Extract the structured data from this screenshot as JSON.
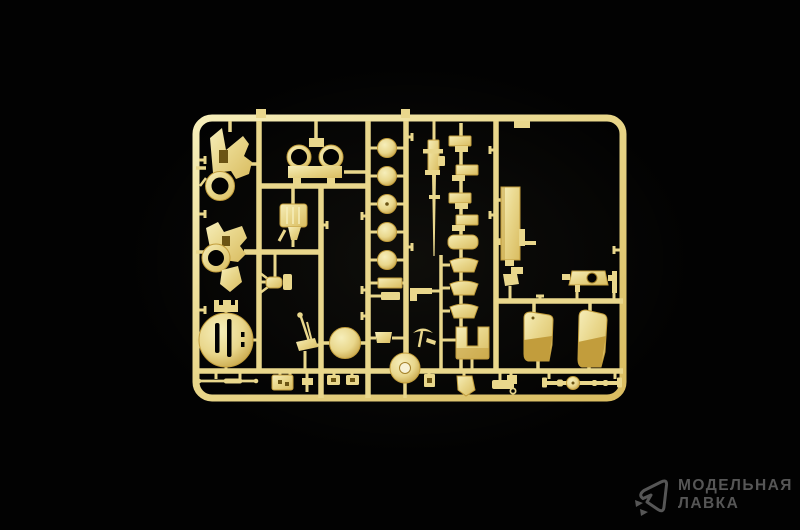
{
  "photo": {
    "type": "product-photo",
    "subject": "model-kit-sprue",
    "background_color": "#020202"
  },
  "sprue": {
    "plastic_color": "#e9d78c",
    "plastic_light": "#f6eeba",
    "plastic_dark": "#c29d3c",
    "plastic_deep": "#6b5414",
    "parts": [
      "sprue-frame",
      "runners",
      "gate-clips",
      "transfer-case-a",
      "transfer-case-b",
      "slotted-disc",
      "front-axle",
      "tool-box",
      "twin-ring-mount",
      "jerry-can",
      "tow-hitch",
      "gear-lever",
      "road-wheel",
      "hub-discs",
      "spare-hub-disc",
      "small-trapezoid-bracket",
      "machine-gun",
      "pickaxe",
      "l-bracket",
      "leaf-spring-brackets",
      "mudguard-panels",
      "u-shaped-panel",
      "chassis-rail",
      "rail-feet",
      "gun-mount-plate",
      "seat-left",
      "seat-right",
      "rear-axle",
      "plate-pair",
      "small-brackets",
      "boot-bracket",
      "angle-bracket",
      "clamp-bracket",
      "ring-eyelet"
    ]
  },
  "watermark": {
    "line1": "МОДЕЛЬНАЯ",
    "line2": "ЛАВКА",
    "color": "#565656",
    "icon": "paper-plane-logo-icon"
  }
}
